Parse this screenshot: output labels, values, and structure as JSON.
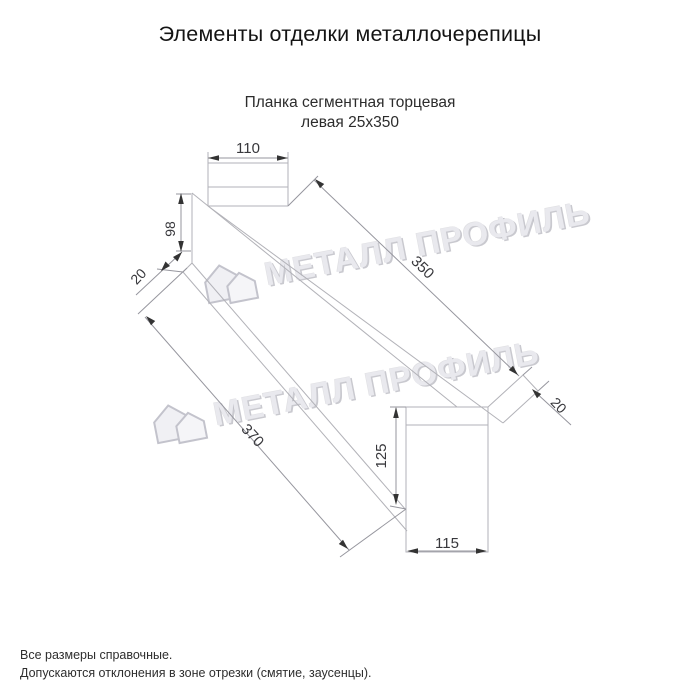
{
  "header": {
    "title": "Элементы отделки металлочерепицы"
  },
  "product": {
    "name_line1": "Планка сегментная торцевая",
    "name_line2": "левая 25х350"
  },
  "dimensions": {
    "top_face_width": "110",
    "left_end_height": "98",
    "left_end_hem": "20",
    "length_top": "350",
    "length_bottom": "370",
    "end_face_height": "125",
    "end_face_width": "115",
    "end_hem": "20"
  },
  "watermark": {
    "text": "МЕТАЛЛ ПРОФИЛЬ"
  },
  "footer": {
    "note1": "Все размеры справочные.",
    "note2": "Допускаются отклонения в зоне отрезки (смятие, заусенцы)."
  },
  "colors": {
    "background": "#ffffff",
    "part_lines": "#b2b2b8",
    "dimension_lines": "#96969e",
    "dimension_text": "#38383c",
    "title_text": "#141414",
    "watermark": "#e9e9ee"
  }
}
